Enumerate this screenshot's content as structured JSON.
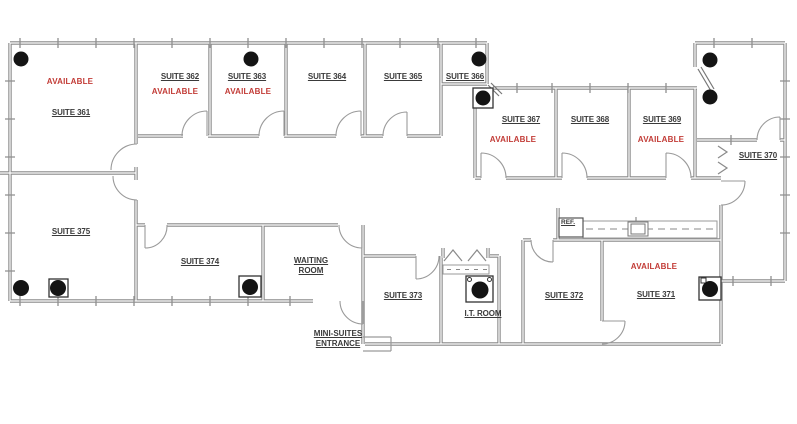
{
  "colors": {
    "available_red": "#c23b36",
    "label_gray": "#3a3a3a",
    "wall_gray": "#8a8a8a",
    "dot_black": "#141414"
  },
  "rooms": {
    "s361": {
      "name": "SUITE 361",
      "status": "AVAILABLE"
    },
    "s362": {
      "name": "SUITE 362",
      "status": "AVAILABLE"
    },
    "s363": {
      "name": "SUITE 363",
      "status": "AVAILABLE"
    },
    "s364": {
      "name": "SUITE 364"
    },
    "s365": {
      "name": "SUITE 365"
    },
    "s366": {
      "name": "SUITE 366"
    },
    "s367": {
      "name": "SUITE 367",
      "status": "AVAILABLE"
    },
    "s368": {
      "name": "SUITE 368"
    },
    "s369": {
      "name": "SUITE 369",
      "status": "AVAILABLE"
    },
    "s370": {
      "name": "SUITE 370"
    },
    "s371": {
      "name": "SUITE 371",
      "status": "AVAILABLE"
    },
    "s372": {
      "name": "SUITE 372"
    },
    "s373": {
      "name": "SUITE 373"
    },
    "s374": {
      "name": "SUITE 374"
    },
    "s375": {
      "name": "SUITE 375"
    }
  },
  "areas": {
    "waiting_room": {
      "line1": "WAITING",
      "line2": "ROOM"
    },
    "entrance": {
      "line1": "MINI-SUITES",
      "line2": "ENTRANCE"
    },
    "it_room": {
      "name": "I.T. ROOM"
    },
    "kitchen": {
      "ref_label": "REF."
    }
  }
}
